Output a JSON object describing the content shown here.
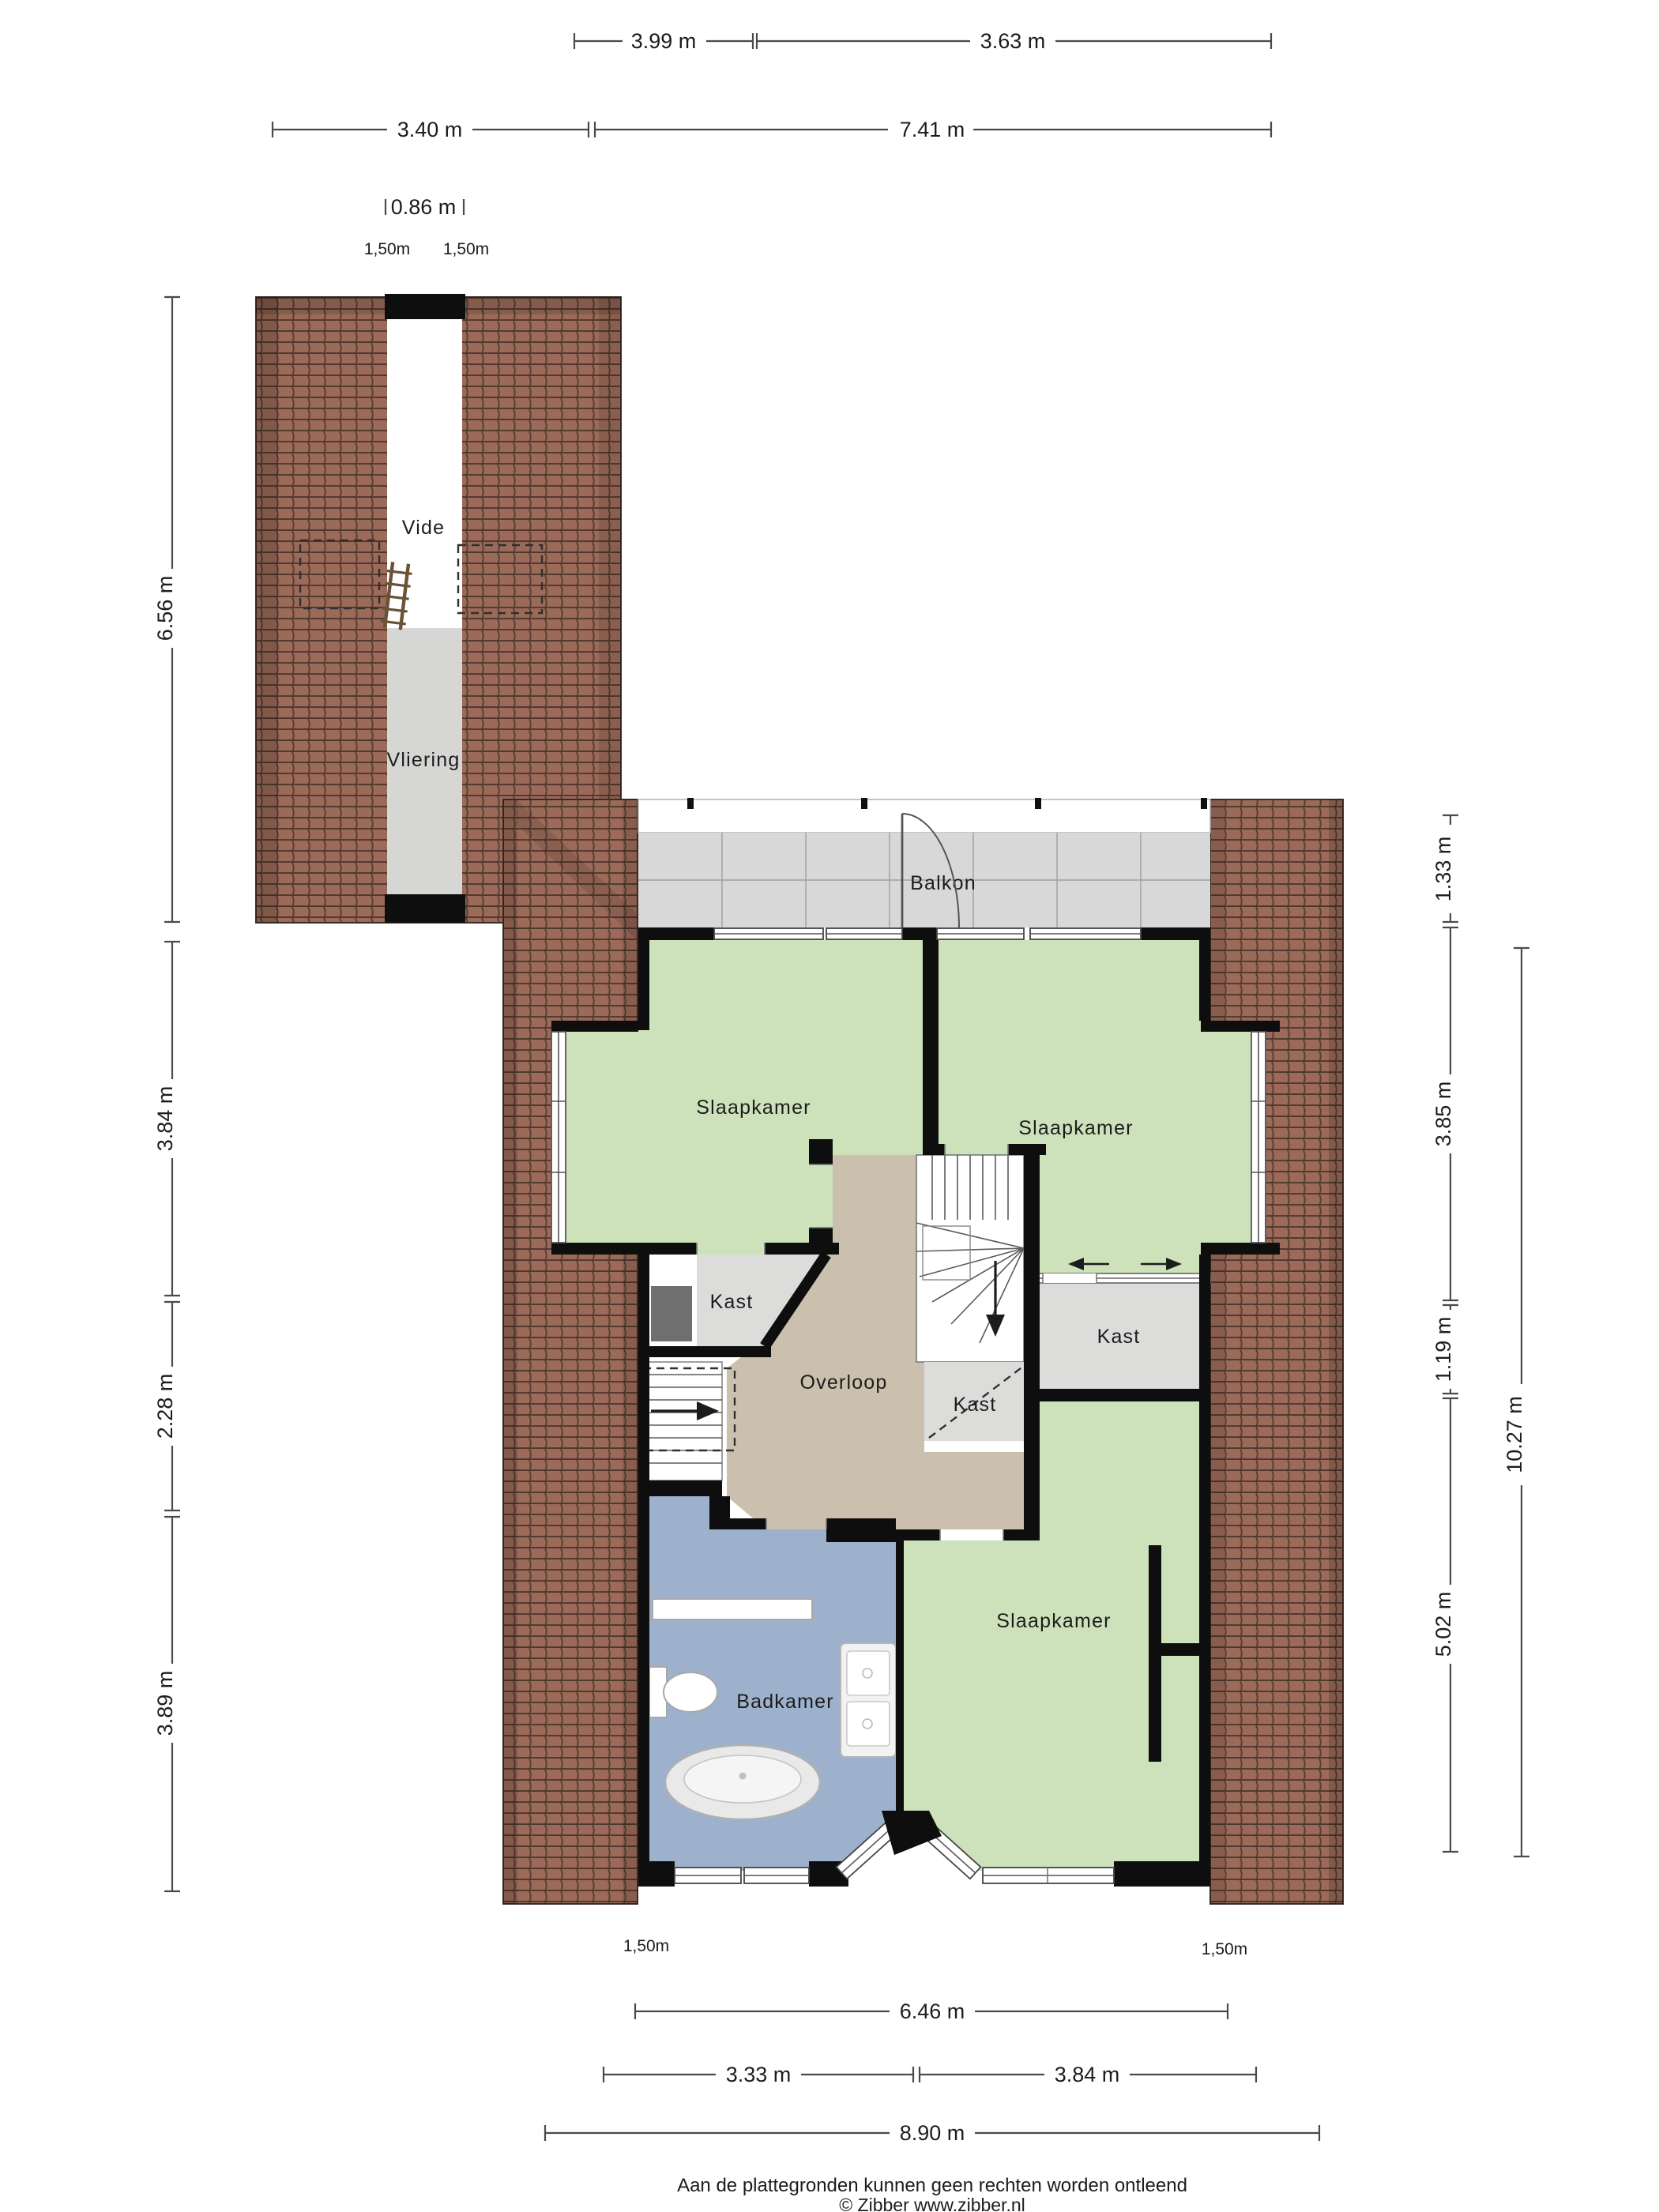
{
  "footer": {
    "line1": "Aan de plattegronden kunnen geen rechten worden ontleend",
    "line2": "© Zibber www.zibber.nl"
  },
  "rooms": {
    "vide": "Vide",
    "vliering": "Vliering",
    "balkon": "Balkon",
    "bedroom_tl": "Slaapkamer",
    "bedroom_tr": "Slaapkamer",
    "bedroom_bottom": "Slaapkamer",
    "kast_left": "Kast",
    "kast_under_stairs": "Kast",
    "kast_right": "Kast",
    "overloop": "Overloop",
    "badkamer": "Badkamer"
  },
  "dimensions": {
    "top_399": "3.99 m",
    "top_363": "3.63 m",
    "top_340": "3.40 m",
    "top_741": "7.41 m",
    "top_086": "0.86 m",
    "top_150_left": "1,50m",
    "top_150_right": "1,50m",
    "left_656": "6.56 m",
    "left_384": "3.84 m",
    "left_228": "2.28 m",
    "left_389": "3.89 m",
    "right_133": "1.33 m",
    "right_385": "3.85 m",
    "right_119": "1.19 m",
    "right_502": "5.02 m",
    "right_1027": "10.27 m",
    "bottom_150_left": "1,50m",
    "bottom_150_right": "1,50m",
    "bottom_646": "6.46 m",
    "bottom_333": "3.33 m",
    "bottom_384": "3.84 m",
    "bottom_890": "8.90 m"
  },
  "colors": {
    "roof": "#9b6a58",
    "wall": "#0e0e0e",
    "room_green": "#cde2ba",
    "hall_tan": "#cbbfae",
    "bath_blue": "#9db1cd",
    "closet_gray": "#dcdcdb",
    "dark_gray": "#6f6f6f",
    "balcony_gray": "#d8d8d8",
    "vliering_gray": "#d6d6d4",
    "white": "#ffffff"
  }
}
